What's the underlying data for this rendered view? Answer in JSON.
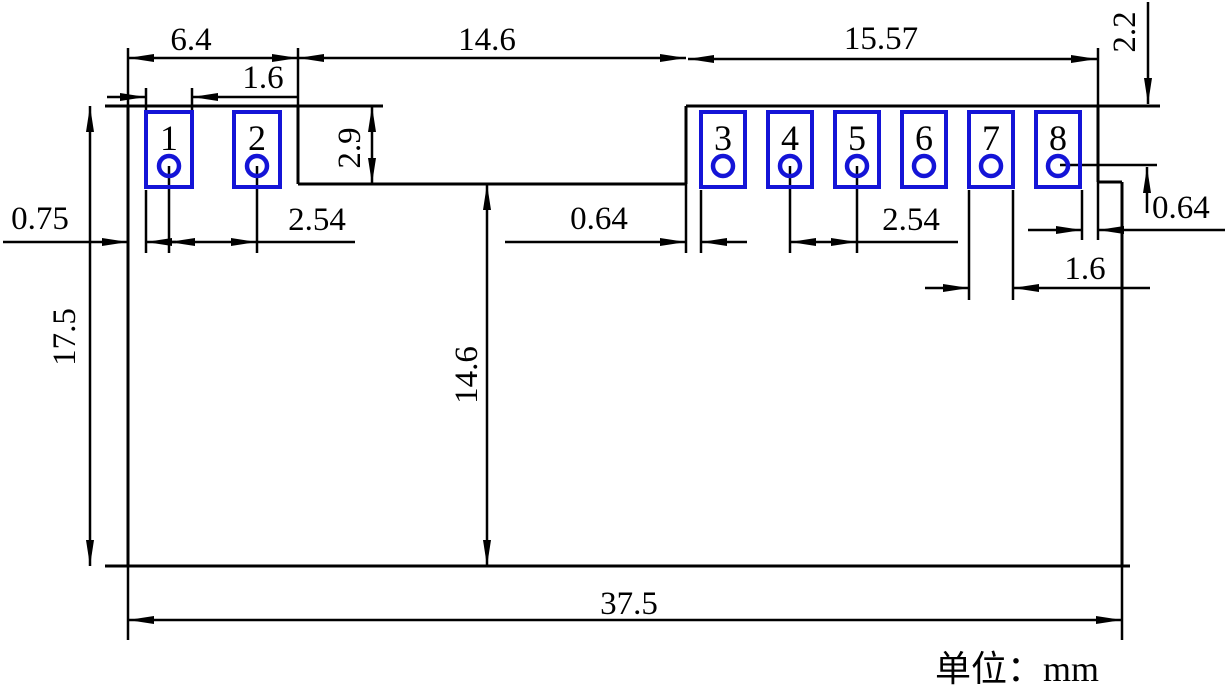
{
  "drawing": {
    "unit_note": "单位：mm",
    "pad_numbers": [
      "1",
      "2",
      "3",
      "4",
      "5",
      "6",
      "7",
      "8"
    ],
    "dimensions": {
      "top_left_tab_width": "6.4",
      "pad1_width": "1.6",
      "middle_notch_width": "14.6",
      "right_tab_width": "15.57",
      "right_top_offset": "2.2",
      "tab_height": "2.9",
      "left_edge_to_pad1": "0.75",
      "left_pad_pitch": "2.54",
      "edge_to_pad3_gap": "0.64",
      "right_pad_pitch": "2.54",
      "pad8_edge_offset": "0.64",
      "pad7_width": "1.6",
      "board_height": "17.5",
      "notch_to_bottom_height": "14.6",
      "board_width": "37.5"
    },
    "colors": {
      "line": "#000000",
      "pad_outline": "#1414d7",
      "pad_number": "#c42c2c",
      "background": "#ffffff"
    }
  }
}
